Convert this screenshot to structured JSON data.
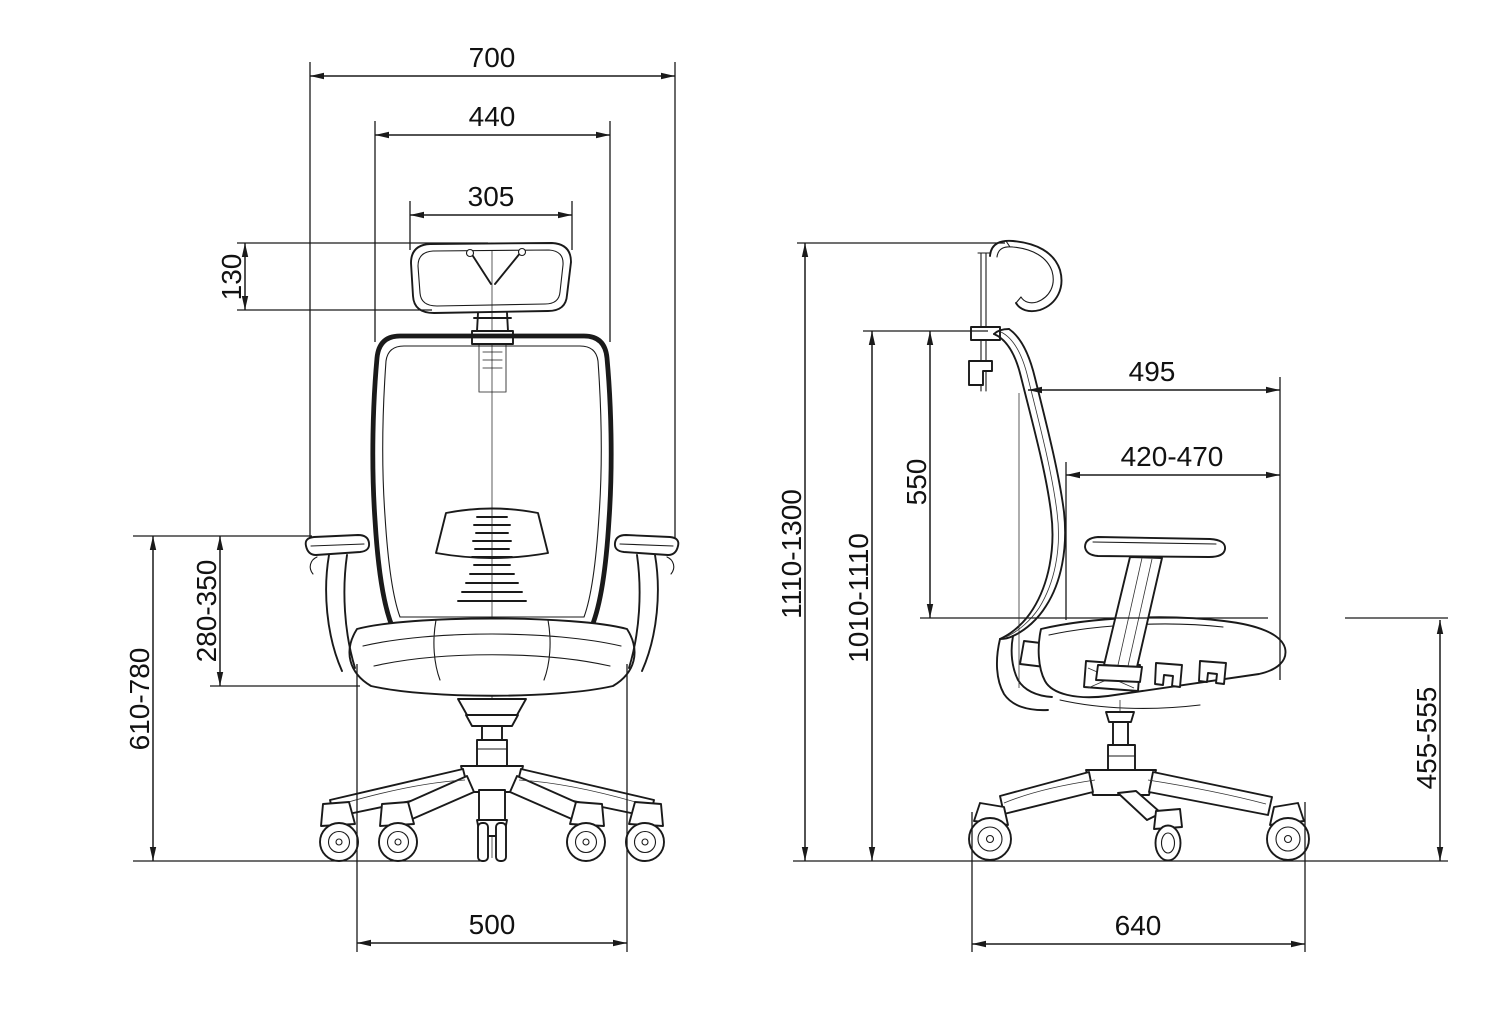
{
  "drawing": {
    "background": "#ffffff",
    "line_color": "#1a1a1a",
    "views": {
      "front": {
        "dimensions": {
          "overall_width": "700",
          "backrest_width": "440",
          "headrest_width": "305",
          "headrest_height": "130",
          "armrest_above_seat": "280-350",
          "armrest_height_from_floor": "610-780",
          "seat_width": "500"
        }
      },
      "side": {
        "dimensions": {
          "seat_total_depth": "495",
          "seat_depth_adjustable": "420-470",
          "backrest_height": "550",
          "overall_height": "1110-1300",
          "backrest_top_height": "1010-1110",
          "seat_height": "455-555",
          "base_footprint_depth": "640"
        }
      }
    }
  }
}
